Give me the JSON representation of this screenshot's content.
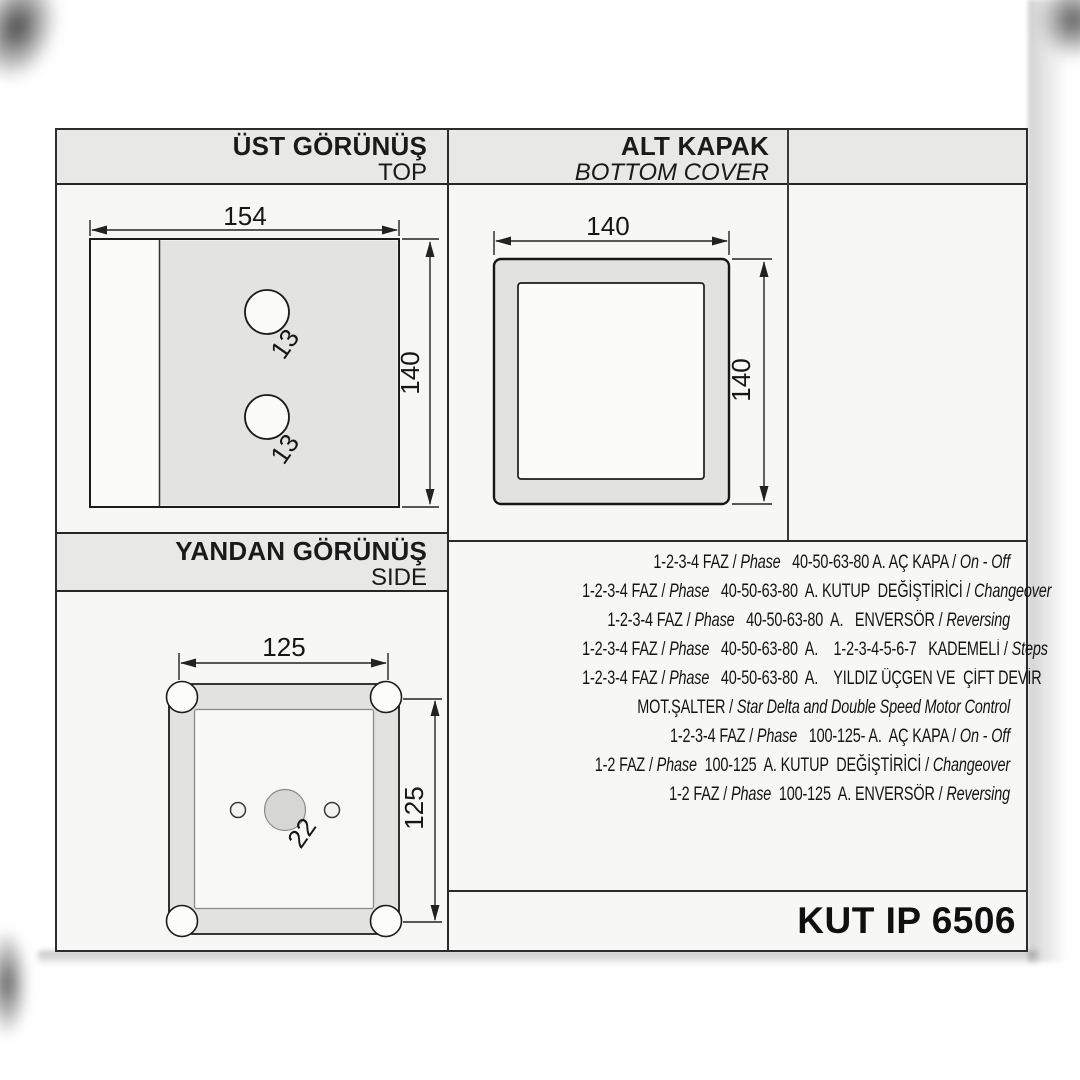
{
  "page": {
    "model": "KUT IP 6506"
  },
  "panels": {
    "top_view": {
      "title_tr": "ÜST GÖRÜNÜŞ",
      "title_en": "TOP",
      "dim_width": "154",
      "dim_height": "140",
      "hole_dia": "13"
    },
    "bottom_cover": {
      "title_tr": "ALT KAPAK",
      "title_en": "BOTTOM COVER",
      "dim_width": "140",
      "dim_height": "140"
    },
    "side_view": {
      "title_tr": "YANDAN GÖRÜNÜŞ",
      "title_en": "SIDE",
      "dim_width": "125",
      "dim_height": "125",
      "hole_dia": "22"
    }
  },
  "spec": {
    "lines": [
      [
        {
          "t": "1-2-3-4 FAZ / "
        },
        {
          "t": "Phase",
          "i": 1
        },
        {
          "t": "   40-50-63-80 A. AÇ KAPA / "
        },
        {
          "t": "On - Off",
          "i": 1
        }
      ],
      [
        {
          "t": "1-2-3-4 FAZ / "
        },
        {
          "t": "Phase",
          "i": 1
        },
        {
          "t": "   40-50-63-80  A. KUTUP  DEĞİŞTİRİCİ / "
        },
        {
          "t": "Changeover",
          "i": 1
        }
      ],
      [
        {
          "t": "1-2-3-4 FAZ / "
        },
        {
          "t": "Phase",
          "i": 1
        },
        {
          "t": "   40-50-63-80  A.   ENVERSÖR / "
        },
        {
          "t": "Reversing",
          "i": 1
        }
      ],
      [
        {
          "t": "1-2-3-4 FAZ / "
        },
        {
          "t": "Phase",
          "i": 1
        },
        {
          "t": "   40-50-63-80  A.    1-2-3-4-5-6-7   KADEMELİ / "
        },
        {
          "t": "Steps",
          "i": 1
        }
      ],
      [
        {
          "t": "1-2-3-4 FAZ / "
        },
        {
          "t": "Phase",
          "i": 1
        },
        {
          "t": "   40-50-63-80  A.    YILDIZ ÜÇGEN VE  ÇİFT DEVİR"
        }
      ],
      [
        {
          "t": "MOT.ŞALTER / "
        },
        {
          "t": "Star Delta and Double Speed Motor Control",
          "i": 1
        }
      ],
      [
        {
          "t": "1-2-3-4 FAZ / "
        },
        {
          "t": "Phase",
          "i": 1
        },
        {
          "t": "   100-125- A.  AÇ KAPA / "
        },
        {
          "t": "On - Off",
          "i": 1
        }
      ],
      [
        {
          "t": "1-2 FAZ / "
        },
        {
          "t": "Phase",
          "i": 1
        },
        {
          "t": "  100-125  A. KUTUP  DEĞİŞTİRİCİ / "
        },
        {
          "t": "Changeover",
          "i": 1
        }
      ],
      [
        {
          "t": "1-2 FAZ / "
        },
        {
          "t": "Phase",
          "i": 1
        },
        {
          "t": "  100-125  A. ENVERSÖR / "
        },
        {
          "t": "Reversing",
          "i": 1
        }
      ]
    ]
  }
}
